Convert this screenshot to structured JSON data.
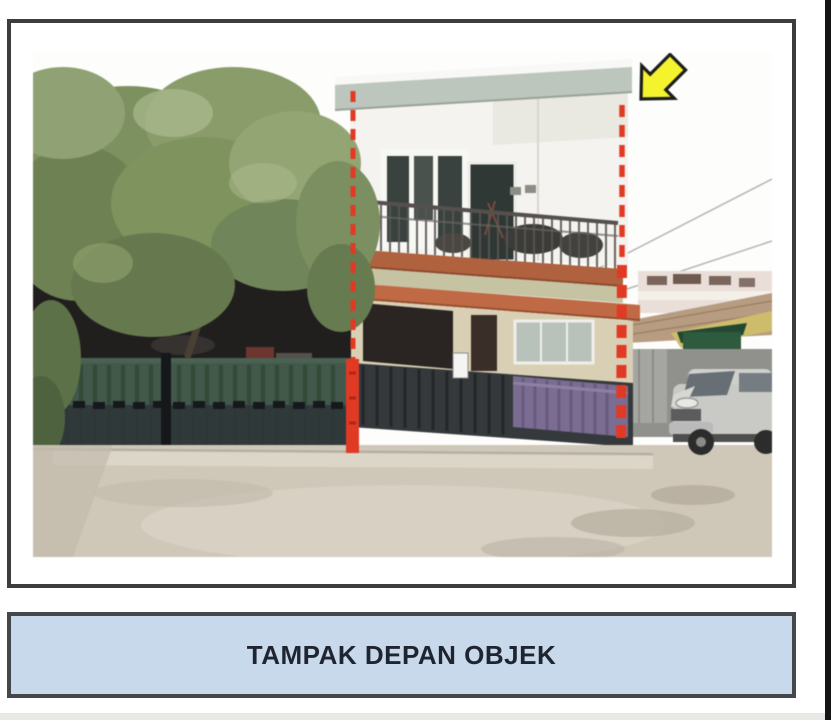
{
  "document": {
    "caption": {
      "label": "TAMPAK DEPAN OBJEK"
    },
    "photo": {
      "subject": "front-view-of-two-storey-house",
      "annotations": [
        {
          "name": "object-arrow",
          "shape": "block-arrow-down-left",
          "color": "#f4f32e"
        },
        {
          "name": "object-boundary-left",
          "shape": "red-dashed-vertical-line",
          "color": "#e13a24"
        },
        {
          "name": "object-boundary-right",
          "shape": "red-dashed-vertical-line",
          "color": "#e13a24"
        }
      ]
    },
    "theme": {
      "frame_border": "#3d3d3d",
      "caption_bg": "#c9d9ec",
      "caption_border": "#45484b",
      "caption_text": "#1f2530",
      "page_rule": "#151515",
      "annotation_red": "#e13a24",
      "annotation_yellow": "#f4f32e",
      "annotation_outline": "#1c1c1c"
    }
  }
}
